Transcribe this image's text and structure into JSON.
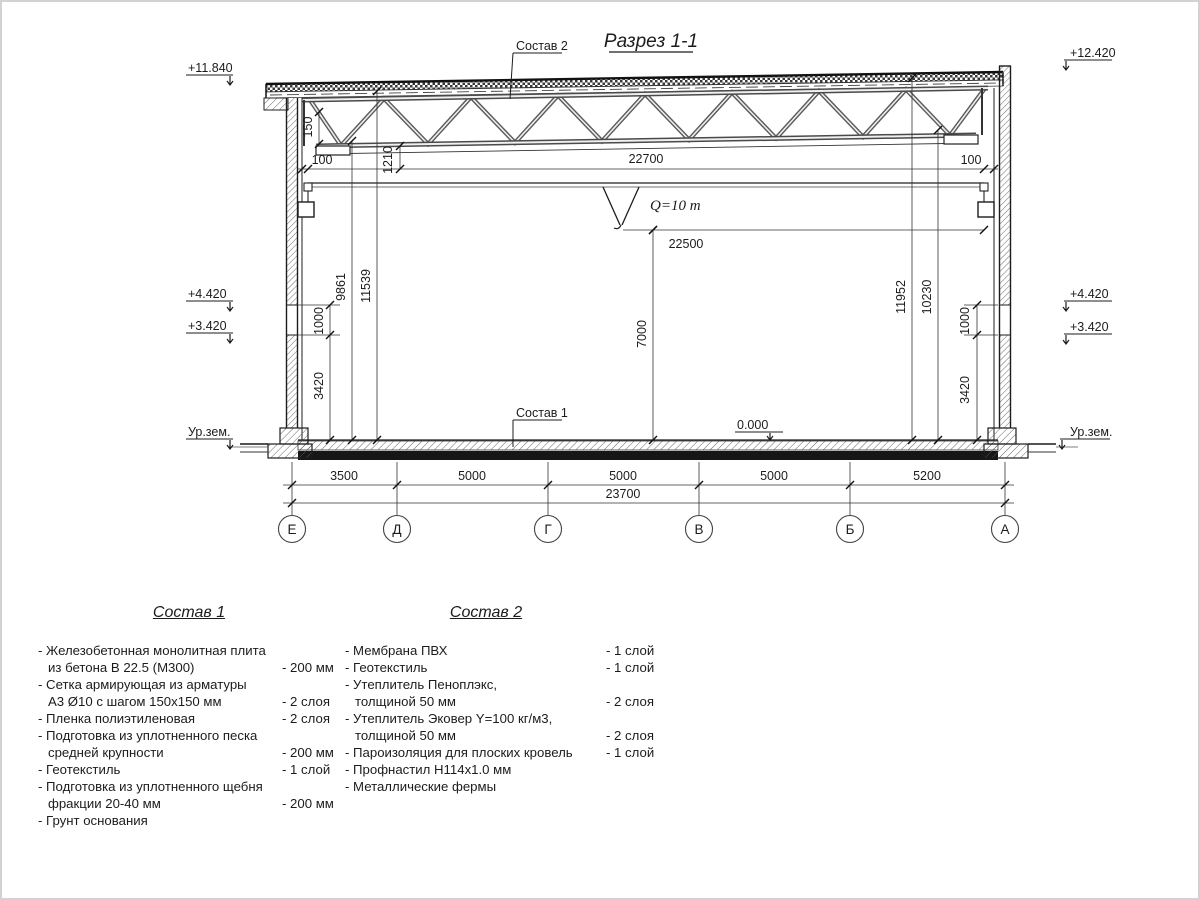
{
  "drawing": {
    "title": "Разрез 1-1",
    "callout_top": "Состав 2",
    "callout_floor": "Состав 1",
    "crane_label": "Q=10 m",
    "marks": {
      "left_roof": "+11.840",
      "left_crane_top": "+4.420",
      "left_crane_bottom": "+3.420",
      "left_ground": "Ур.зем.",
      "right_roof": "+12.420",
      "right_crane_top": "+4.420",
      "right_crane_bottom": "+3.420",
      "right_ground": "Ур.зем.",
      "floor_zero": "0.000"
    },
    "dims": {
      "roof_span": "22700",
      "gap_left": "100",
      "gap_right": "100",
      "truss_150": "150",
      "truss_1210": "1210",
      "crane_span": "22500",
      "hook_height": "7000",
      "left_9861": "9861",
      "left_11539": "11539",
      "left_1000": "1000",
      "left_3420": "3420",
      "right_11952": "11952",
      "right_10230": "10230",
      "right_1000": "1000",
      "right_3420": "3420"
    },
    "axes": [
      "Е",
      "Д",
      "Г",
      "В",
      "Б",
      "А"
    ],
    "bottom_dims": [
      "3500",
      "5000",
      "5000",
      "5000",
      "5200"
    ],
    "bottom_total": "23700"
  },
  "sostav1": {
    "heading": "Состав 1",
    "rows": [
      {
        "t": "- Железобетонная  монолитная плита",
        "v": ""
      },
      {
        "t": "из бетона В 22.5 (М300)",
        "v": "- 200 мм"
      },
      {
        "t": "- Сетка армирующая из арматуры",
        "v": ""
      },
      {
        "t": "А3 Ø10 с шагом 150х150 мм",
        "v": "- 2 слоя"
      },
      {
        "t": "- Пленка полиэтиленовая",
        "v": "- 2 слоя"
      },
      {
        "t": "- Подготовка из уплотненного песка",
        "v": ""
      },
      {
        "t": "средней крупности",
        "v": "- 200 мм"
      },
      {
        "t": "- Геотекстиль",
        "v": "- 1 слой"
      },
      {
        "t": "- Подготовка из уплотненного щебня",
        "v": ""
      },
      {
        "t": "фракции 20-40 мм",
        "v": "- 200 мм"
      },
      {
        "t": "- Грунт основания",
        "v": ""
      }
    ]
  },
  "sostav2": {
    "heading": "Состав 2",
    "rows": [
      {
        "t": "- Мембрана ПВХ",
        "v": "- 1 слой"
      },
      {
        "t": "- Геотекстиль",
        "v": "- 1 слой"
      },
      {
        "t": "- Утеплитель Пеноплэкс,",
        "v": ""
      },
      {
        "t": "толщиной 50 мм",
        "v": "- 2 слоя"
      },
      {
        "t": "- Утеплитель Эковер Y=100 кг/м3,",
        "v": ""
      },
      {
        "t": "толщиной 50 мм",
        "v": "- 2 слоя"
      },
      {
        "t": "- Пароизоляция для плоских кровель",
        "v": "- 1 слой"
      },
      {
        "t": "- Профнастил Н114х1.0 мм",
        "v": ""
      },
      {
        "t": "- Металлические фермы",
        "v": ""
      }
    ]
  }
}
